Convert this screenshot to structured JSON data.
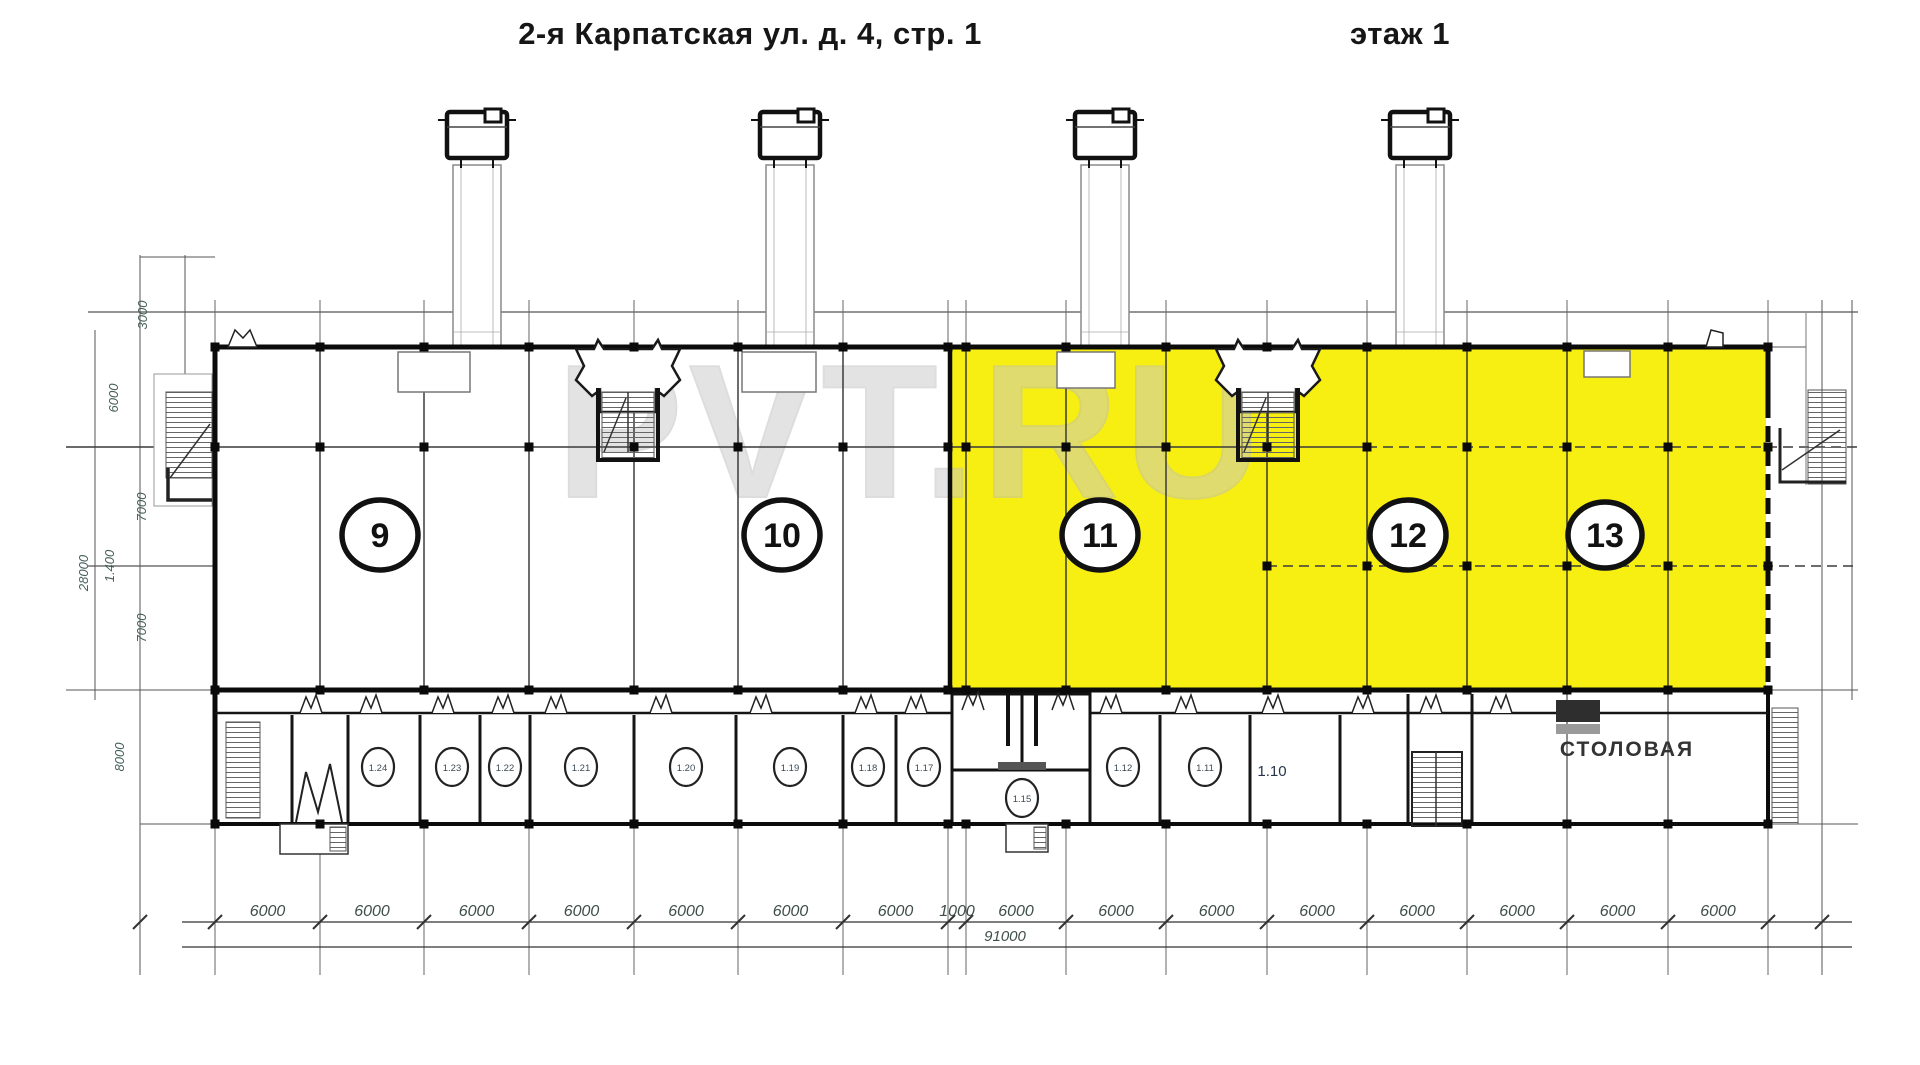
{
  "header": {
    "title": "2-я Карпатская ул. д. 4, стр. 1",
    "floor": "этаж 1"
  },
  "watermark": "PVT.RU",
  "sections": [
    {
      "number": "9",
      "highlighted": false
    },
    {
      "number": "10",
      "highlighted": false
    },
    {
      "number": "11",
      "highlighted": true
    },
    {
      "number": "12",
      "highlighted": true
    },
    {
      "number": "13",
      "highlighted": true
    }
  ],
  "rooms": {
    "small": [
      "1.24",
      "1.23",
      "1.22",
      "1.21",
      "1.20",
      "1.19",
      "1.18",
      "1.17",
      "1.15",
      "1.12",
      "1.11"
    ],
    "plain": "1.10",
    "canteen": "СТОЛОВАЯ"
  },
  "dimensions": {
    "bottom": [
      "6000",
      "6000",
      "6000",
      "6000",
      "6000",
      "6000",
      "6000",
      "1000",
      "6000",
      "6000",
      "6000",
      "6000",
      "6000",
      "6000",
      "6000",
      "6000"
    ],
    "total": "91000",
    "left": [
      "3000",
      "6000",
      "7000",
      "1.400",
      "28000",
      "7000",
      "8000"
    ]
  },
  "colors": {
    "highlight": "#f7ee12",
    "wall": "#0b0b0b",
    "grid": "#3a3a3a",
    "dim_text": "#3e4e49",
    "watermark": "#c9c9c9"
  }
}
